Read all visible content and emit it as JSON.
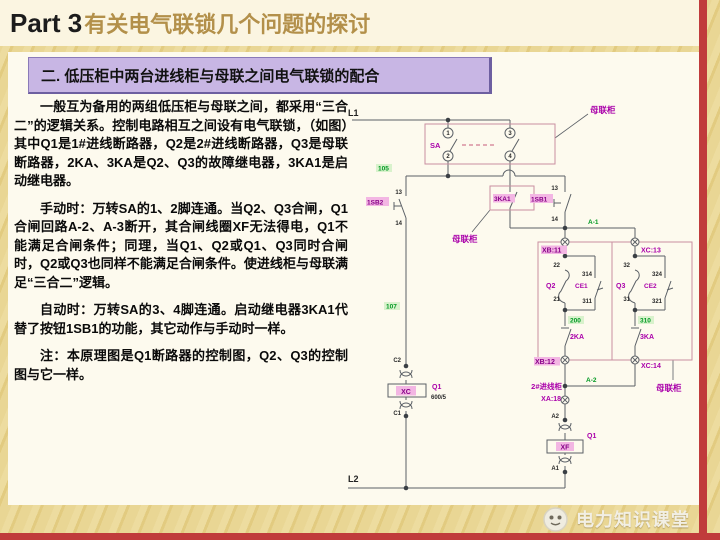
{
  "header": {
    "title_prefix": "Part 3",
    "title": "有关电气联锁几个问题的探讨",
    "subtitle": "二. 低压柜中两台进线柜与母联之间电气联锁的配合"
  },
  "content": {
    "paragraphs": [
      "一般互为备用的两组低压柜与母联之间，都采用“三合二”的逻辑关系。控制电路相互之间设有电气联锁，（如图）其中Q1是1#进线断路器，Q2是2#进线断路器，Q3是母联断路器，2KA、3KA是Q2、Q3的故障继电器，3KA1是启动继电器。",
      "手动时：万转SA的1、2脚连通。当Q2、Q3合闸，Q1合闸回路A-2、A-3断开，其合闸线圈XF无法得电，Q1不能满足合闸条件；同理，当Q1、Q2或Q1、Q3同时合闸时，Q2或Q3也同样不能满足合闸条件。使进线柜与母联满足“三合二”逻辑。",
      "自动时：万转SA的3、4脚连通。启动继电器3KA1代替了按钮1SB1的功能，其它动作与手动时一样。",
      "注：本原理图是Q1断路器的控制图，Q2、Q3的控制图与它一样。"
    ]
  },
  "footer": {
    "brand": "电力知识课堂"
  },
  "colors": {
    "accent_red": "#c03b3b",
    "panel_lavender": "#c8b6e4",
    "title_gold": "#b3904a",
    "label_magenta": "#aa00aa",
    "wire_green": "#009922",
    "diagram_pink": "#c98fa0"
  },
  "diagram": {
    "rails": {
      "l1": "L1",
      "l2": "L2"
    },
    "selector": {
      "label": "SA",
      "pin1": "1",
      "pin2": "2",
      "pin3": "3",
      "pin4": "4",
      "cabinet": "母联柜"
    },
    "sb2": {
      "label": "1SB2",
      "top": "13",
      "bottom": "14"
    },
    "sb1": {
      "label": "1SB1",
      "top": "13",
      "bottom": "14"
    },
    "ka1": {
      "label": "3KA1",
      "cabinet": "母联柜"
    },
    "wires": {
      "w105": "105",
      "w107": "107",
      "a1": "A-1",
      "a2": "A-2",
      "w200": "200",
      "w310": "310"
    },
    "terminals": {
      "xb11": "XB:11",
      "xb12": "XB:12",
      "xc13": "XC:13",
      "xc14": "XC:14",
      "xa18": "XA:18"
    },
    "q2": {
      "label": "Q2",
      "top": "22",
      "bottom": "21",
      "aux": "CE1",
      "aux_top": "314",
      "aux_bottom": "311",
      "relay": "2KA"
    },
    "q3": {
      "label": "Q3",
      "top": "32",
      "bottom": "31",
      "aux": "CE2",
      "aux_top": "324",
      "aux_bottom": "321",
      "relay": "3KA"
    },
    "motor": {
      "box": "XC",
      "breaker": "Q1",
      "rating": "600/5",
      "top": "C2",
      "bottom": "C1"
    },
    "coil": {
      "box": "XF",
      "breaker": "Q1",
      "top": "A2",
      "bottom": "A1"
    },
    "cabinets": {
      "incoming": "2#进线柜",
      "coupler": "母联柜"
    }
  }
}
